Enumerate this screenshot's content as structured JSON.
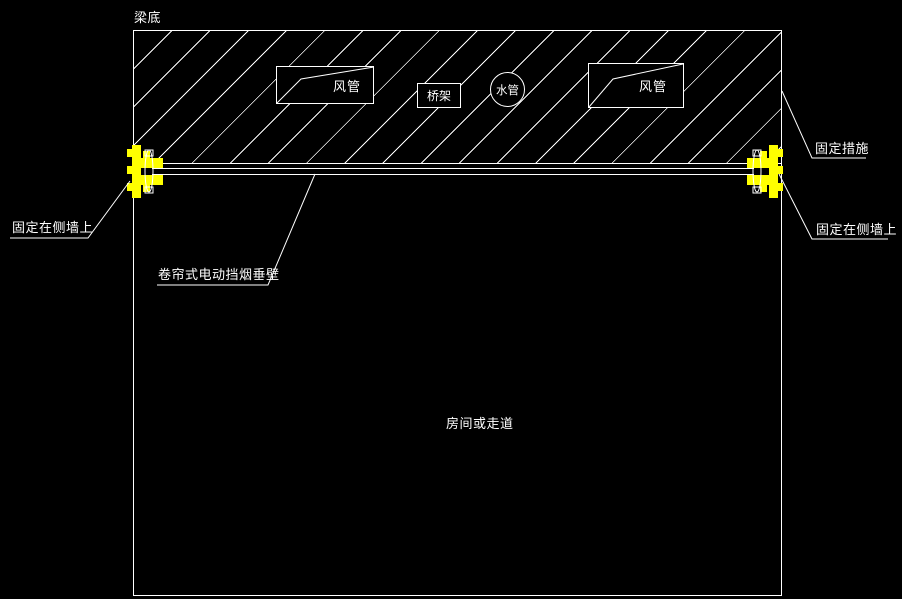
{
  "colors": {
    "background": "#000000",
    "line": "#ffffff",
    "fixture": "#ffff00"
  },
  "slab": {
    "beam_bottom_label": "梁底"
  },
  "services": {
    "duct_left": "风管",
    "cable_tray": "桥架",
    "water_pipe": "水管",
    "duct_right": "风管"
  },
  "annotations": {
    "fixing_measure": "固定措施",
    "fixed_on_side_wall_right": "固定在侧墙上",
    "fixed_on_side_wall_left": "固定在侧墙上",
    "smoke_barrier": "卷帘式电动挡烟垂壁",
    "room_or_corridor": "房间或走道"
  }
}
